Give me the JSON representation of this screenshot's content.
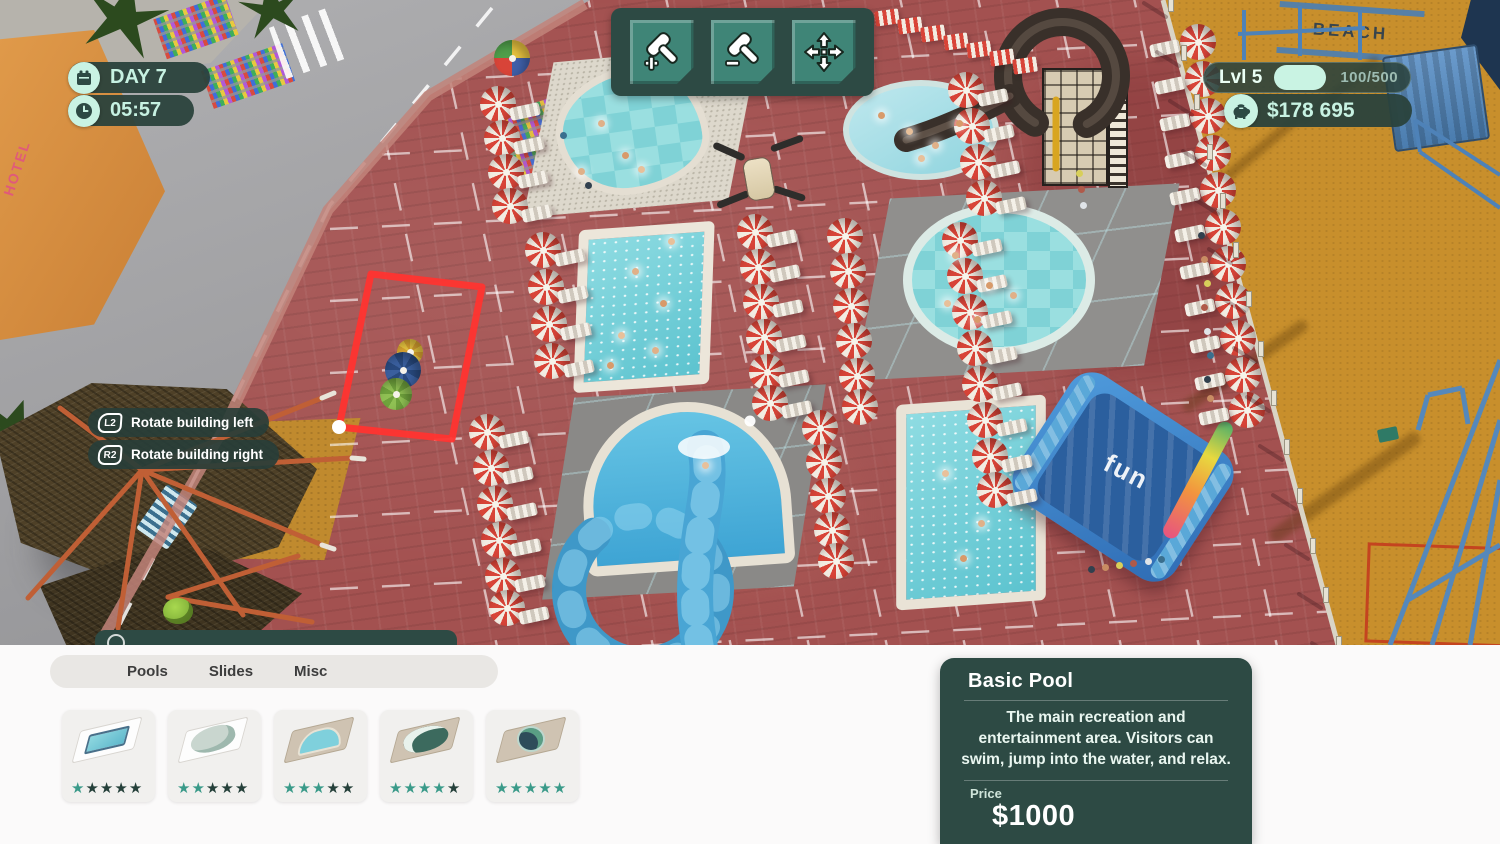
{
  "hud": {
    "day": "DAY 7",
    "time": "05:57",
    "level_label": "Lvl 5",
    "level_progress": "100/500",
    "money": "$178 695",
    "toolbar": {
      "build": "build-hammer-plus",
      "demolish": "demolish-hammer-minus",
      "move": "move-arrows"
    },
    "hints": [
      {
        "button": "L2",
        "label": "Rotate building left"
      },
      {
        "button": "R2",
        "label": "Rotate building right"
      }
    ]
  },
  "build_menu": {
    "tabs": [
      {
        "label": "Pools"
      },
      {
        "label": "Slides"
      },
      {
        "label": "Misc"
      }
    ],
    "items": [
      {
        "name": "basic-pool",
        "stars": 1,
        "max_stars": 5
      },
      {
        "name": "slide-pool",
        "stars": 2,
        "max_stars": 5
      },
      {
        "name": "rounded-pool",
        "stars": 3,
        "max_stars": 5
      },
      {
        "name": "curvy-pool",
        "stars": 4,
        "max_stars": 5
      },
      {
        "name": "round-pool",
        "stars": 5,
        "max_stars": 5
      }
    ]
  },
  "detail_panel": {
    "title": "Basic Pool",
    "description": "The main recreation and entertainment area. Visitors can swim, jump into the water, and relax.",
    "price_label": "Price",
    "price": "$1000"
  },
  "scene_labels": {
    "fun_slide": "fun",
    "beach_sign": "BEACH",
    "hotel_sign": "HOTEL"
  },
  "colors": {
    "accent_mint": "#c7f2e2",
    "panel_teal": "#2d4a44",
    "button_teal": "#3f8577",
    "star_filled": "#3a9a89",
    "star_empty": "#25403a",
    "selection_red": "#ff3430"
  }
}
